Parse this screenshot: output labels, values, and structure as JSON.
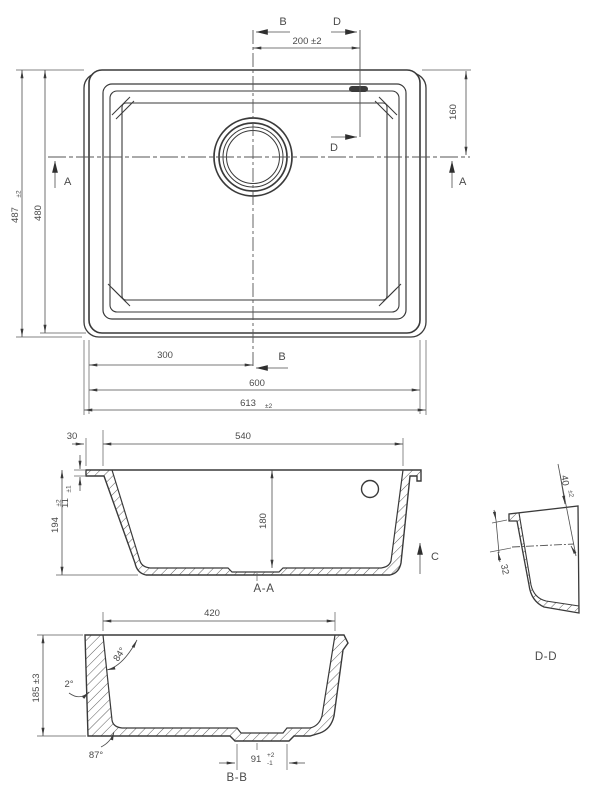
{
  "drawing": {
    "plan": {
      "section_b": "B",
      "section_d": "D",
      "section_a": "A",
      "dim_200": "200 ±2",
      "dim_160": "160",
      "dim_487": "487",
      "dim_487_tol": "±2",
      "dim_480": "480",
      "dim_300": "300",
      "dim_600": "600",
      "dim_613": "613",
      "dim_613_tol": "±2"
    },
    "section_aa": {
      "label": "A-A",
      "dim_30": "30",
      "dim_540": "540",
      "dim_11": "11",
      "dim_11_tol": "±1",
      "dim_194": "194",
      "dim_194_tol": "±2",
      "dim_180": "180",
      "view_c": "C"
    },
    "section_dd": {
      "label": "D-D",
      "dim_40": "40",
      "dim_40_tol": "±2",
      "dim_32": "32"
    },
    "section_bb": {
      "label": "B-B",
      "dim_420": "420",
      "angle_84": "84°",
      "angle_2": "2°",
      "dim_185": "185 ±3",
      "angle_87": "87°",
      "dim_91": "91",
      "dim_91_tol_plus": "+2",
      "dim_91_tol_minus": "-1"
    }
  },
  "colors": {
    "line": "#3a3a3a",
    "dimension": "#4d4d4d",
    "text": "#4a4a4a",
    "background": "#ffffff"
  }
}
